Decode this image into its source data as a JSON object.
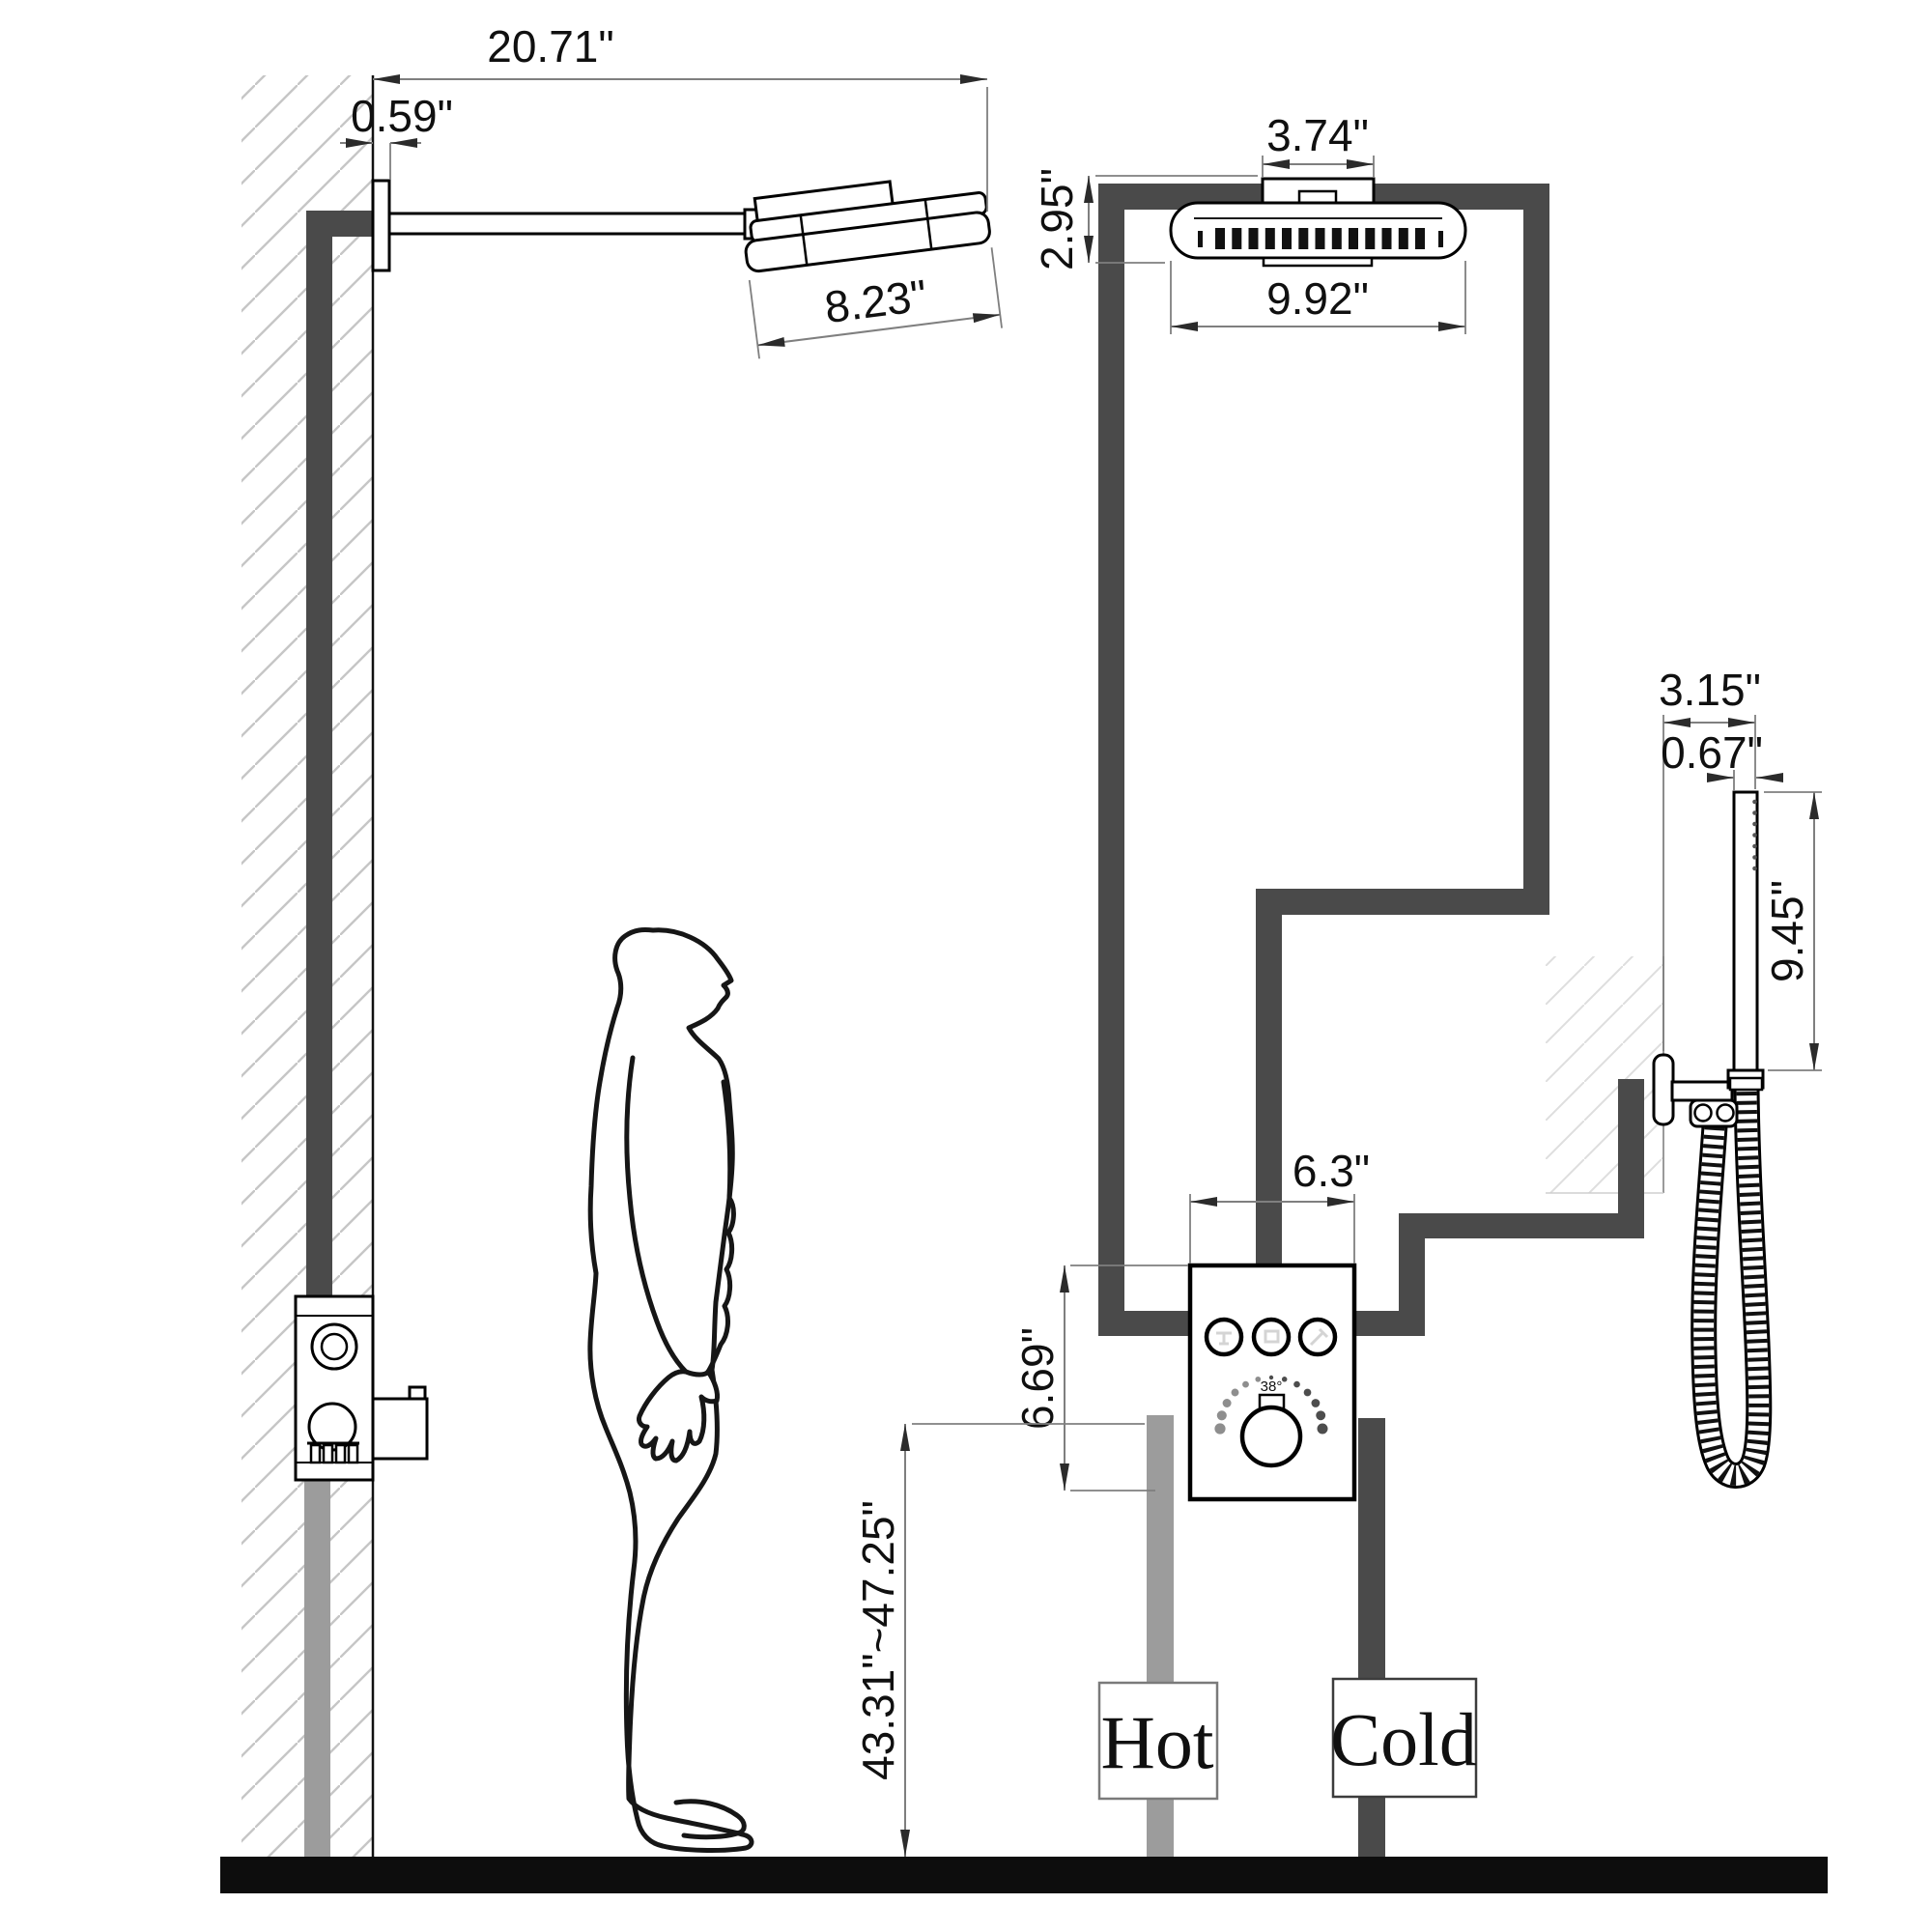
{
  "title": "Shower system installation dimension diagram",
  "dims": {
    "arm_reach": "20.71\"",
    "flange_offset": "0.59\"",
    "head_length": "8.23\"",
    "bracket_width": "3.74\"",
    "head_height": "2.95\"",
    "head_width": "9.92\"",
    "valve_width": "6.3\"",
    "valve_height": "6.69\"",
    "install_height": "43.31\"~47.25\"",
    "hand_mount_width": "3.15\"",
    "wand_thickness": "0.67\"",
    "wand_length": "9.45\""
  },
  "valve": {
    "temp_marker": "38°"
  },
  "supply": {
    "hot": "Hot",
    "cold": "Cold"
  },
  "colors": {
    "pipe_dark": "#4a4a4a",
    "pipe_light": "#9c9c9c",
    "outline": "#000000",
    "dimension": "#7f7f7f",
    "floor": "#0d0d0d",
    "hot_label": "#8a8a8a",
    "cold_label": "#3c3c3c"
  }
}
